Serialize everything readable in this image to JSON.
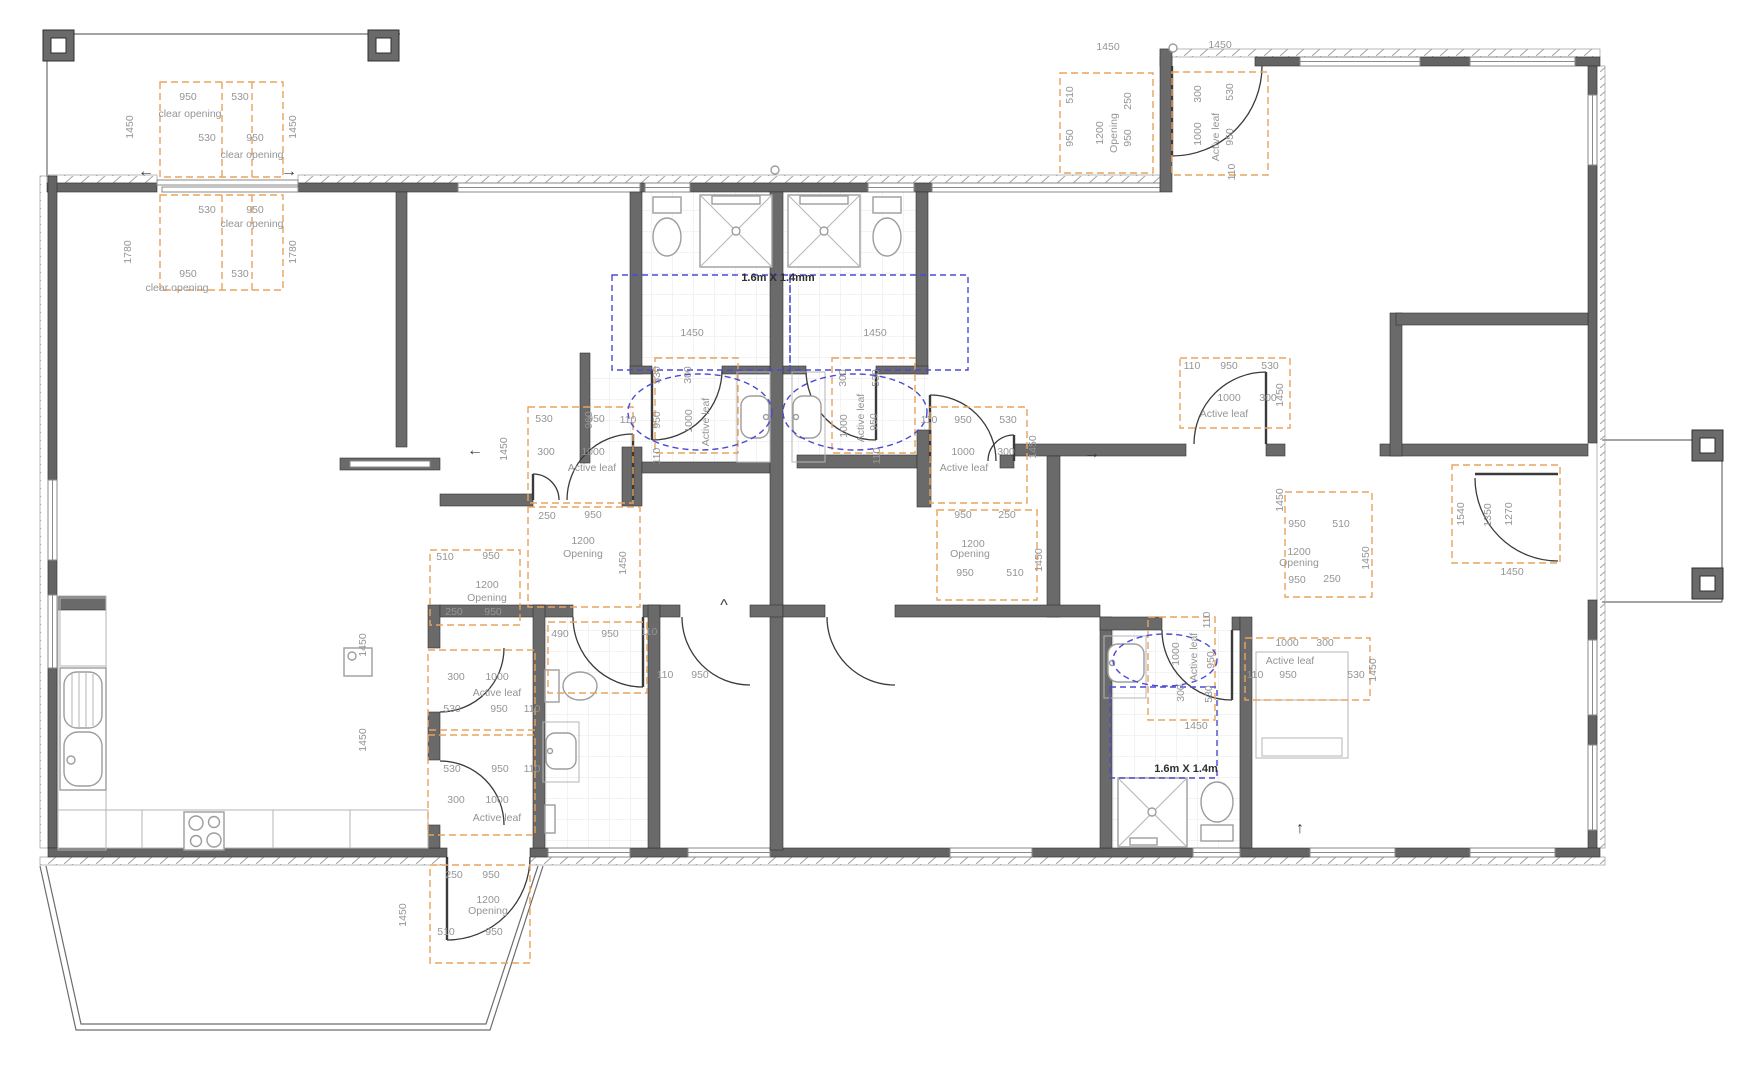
{
  "drawing": {
    "kind": "accessible-house-floor-plan",
    "turning_space_labels": [
      "1.6m X 1.4mm",
      "1.6m X 1.4m"
    ]
  },
  "colors": {
    "wall": "#646464",
    "clearance_dashed": "#e8a35f",
    "turning_dashed": "#4a4ad2",
    "dimension_text": "#959595",
    "background": "#ffffff"
  },
  "annotations": [
    {
      "t": "950",
      "x": 188,
      "y": 100
    },
    {
      "t": "530",
      "x": 240,
      "y": 100
    },
    {
      "t": "clear opening",
      "x": 190,
      "y": 117
    },
    {
      "t": "530",
      "x": 207,
      "y": 141
    },
    {
      "t": "950",
      "x": 255,
      "y": 141
    },
    {
      "t": "clear opening",
      "x": 252,
      "y": 158
    },
    {
      "t": "1450",
      "x": 133,
      "y": 127,
      "r": -90
    },
    {
      "t": "1450",
      "x": 296,
      "y": 127,
      "r": -90
    },
    {
      "t": "530",
      "x": 207,
      "y": 213
    },
    {
      "t": "950",
      "x": 255,
      "y": 213
    },
    {
      "t": "clear opening",
      "x": 252,
      "y": 227
    },
    {
      "t": "950",
      "x": 188,
      "y": 277
    },
    {
      "t": "530",
      "x": 240,
      "y": 277
    },
    {
      "t": "clear opening",
      "x": 177,
      "y": 291
    },
    {
      "t": "1780",
      "x": 131,
      "y": 252,
      "r": -90
    },
    {
      "t": "1780",
      "x": 296,
      "y": 252,
      "r": -90
    },
    {
      "t": "←",
      "x": 146,
      "y": 176,
      "k": "a"
    },
    {
      "t": "→",
      "x": 289,
      "y": 176,
      "k": "a"
    },
    {
      "t": "1450",
      "x": 1108,
      "y": 50
    },
    {
      "t": "1450",
      "x": 1220,
      "y": 48
    },
    {
      "t": "510",
      "x": 1073,
      "y": 95,
      "r": -90
    },
    {
      "t": "250",
      "x": 1131,
      "y": 101,
      "r": -90
    },
    {
      "t": "950",
      "x": 1073,
      "y": 138,
      "r": -90
    },
    {
      "t": "1200",
      "x": 1103,
      "y": 133,
      "r": -90
    },
    {
      "t": "Opening",
      "x": 1117,
      "y": 133,
      "r": -90
    },
    {
      "t": "950",
      "x": 1131,
      "y": 138,
      "r": -90
    },
    {
      "t": "300",
      "x": 1201,
      "y": 94,
      "r": -90
    },
    {
      "t": "530",
      "x": 1233,
      "y": 92,
      "r": -90
    },
    {
      "t": "1000",
      "x": 1201,
      "y": 134,
      "r": -90
    },
    {
      "t": "Active leaf",
      "x": 1219,
      "y": 137,
      "r": -90
    },
    {
      "t": "950",
      "x": 1233,
      "y": 137,
      "r": -90
    },
    {
      "t": "110",
      "x": 1235,
      "y": 172,
      "r": -90
    },
    {
      "t": "1.6m X 1.4mm",
      "x": 778,
      "y": 281,
      "k": "l"
    },
    {
      "t": "1450",
      "x": 692,
      "y": 336
    },
    {
      "t": "1450",
      "x": 875,
      "y": 336
    },
    {
      "t": "530",
      "x": 660,
      "y": 375,
      "r": -90
    },
    {
      "t": "300",
      "x": 691,
      "y": 375,
      "r": -90
    },
    {
      "t": "950",
      "x": 660,
      "y": 420,
      "r": -90
    },
    {
      "t": "1000",
      "x": 692,
      "y": 421,
      "r": -90
    },
    {
      "t": "Active leaf",
      "x": 709,
      "y": 422,
      "r": -90
    },
    {
      "t": "110",
      "x": 660,
      "y": 456,
      "r": -90
    },
    {
      "t": "960",
      "x": 592,
      "y": 420,
      "r": -90
    },
    {
      "t": "300",
      "x": 846,
      "y": 378,
      "r": -90
    },
    {
      "t": "530",
      "x": 879,
      "y": 378,
      "r": -90
    },
    {
      "t": "1000",
      "x": 847,
      "y": 426,
      "r": -90
    },
    {
      "t": "Active leaf",
      "x": 864,
      "y": 418,
      "r": -90
    },
    {
      "t": "950",
      "x": 877,
      "y": 422,
      "r": -90
    },
    {
      "t": "110",
      "x": 880,
      "y": 456,
      "r": -90
    },
    {
      "t": "530",
      "x": 544,
      "y": 422
    },
    {
      "t": "950",
      "x": 596,
      "y": 422
    },
    {
      "t": "110",
      "x": 628,
      "y": 423
    },
    {
      "t": "300",
      "x": 546,
      "y": 455
    },
    {
      "t": "1000",
      "x": 593,
      "y": 455
    },
    {
      "t": "Active leaf",
      "x": 592,
      "y": 471
    },
    {
      "t": "1450",
      "x": 507,
      "y": 449,
      "r": -90
    },
    {
      "t": "250",
      "x": 547,
      "y": 519
    },
    {
      "t": "950",
      "x": 593,
      "y": 518
    },
    {
      "t": "1200",
      "x": 583,
      "y": 544
    },
    {
      "t": "Opening",
      "x": 583,
      "y": 557
    },
    {
      "t": "1450",
      "x": 626,
      "y": 563,
      "r": -90
    },
    {
      "t": "510",
      "x": 445,
      "y": 560
    },
    {
      "t": "950",
      "x": 491,
      "y": 559
    },
    {
      "t": "1200",
      "x": 487,
      "y": 588
    },
    {
      "t": "Opening",
      "x": 487,
      "y": 601
    },
    {
      "t": "250",
      "x": 454,
      "y": 615
    },
    {
      "t": "950",
      "x": 493,
      "y": 615
    },
    {
      "t": "300",
      "x": 456,
      "y": 680
    },
    {
      "t": "1000",
      "x": 497,
      "y": 680
    },
    {
      "t": "Active leaf",
      "x": 497,
      "y": 696
    },
    {
      "t": "530",
      "x": 452,
      "y": 712
    },
    {
      "t": "950",
      "x": 499,
      "y": 712
    },
    {
      "t": "110",
      "x": 532,
      "y": 712
    },
    {
      "t": "530",
      "x": 452,
      "y": 772
    },
    {
      "t": "950",
      "x": 500,
      "y": 772
    },
    {
      "t": "110",
      "x": 532,
      "y": 772
    },
    {
      "t": "300",
      "x": 456,
      "y": 803
    },
    {
      "t": "1000",
      "x": 497,
      "y": 803
    },
    {
      "t": "Active leaf",
      "x": 497,
      "y": 821
    },
    {
      "t": "1450",
      "x": 366,
      "y": 645,
      "r": -90
    },
    {
      "t": "1450",
      "x": 366,
      "y": 740,
      "r": -90
    },
    {
      "t": "490",
      "x": 560,
      "y": 637
    },
    {
      "t": "950",
      "x": 610,
      "y": 637
    },
    {
      "t": "110",
      "x": 649,
      "y": 635
    },
    {
      "t": "110",
      "x": 665,
      "y": 678
    },
    {
      "t": "950",
      "x": 700,
      "y": 678
    },
    {
      "t": "250",
      "x": 454,
      "y": 878
    },
    {
      "t": "950",
      "x": 491,
      "y": 878
    },
    {
      "t": "1200",
      "x": 488,
      "y": 903
    },
    {
      "t": "Opening",
      "x": 488,
      "y": 914
    },
    {
      "t": "510",
      "x": 446,
      "y": 935
    },
    {
      "t": "950",
      "x": 494,
      "y": 935
    },
    {
      "t": "1450",
      "x": 406,
      "y": 915,
      "r": -90
    },
    {
      "t": "110",
      "x": 929,
      "y": 423
    },
    {
      "t": "950",
      "x": 963,
      "y": 423
    },
    {
      "t": "530",
      "x": 1008,
      "y": 423
    },
    {
      "t": "1000",
      "x": 963,
      "y": 455
    },
    {
      "t": "300",
      "x": 1006,
      "y": 455
    },
    {
      "t": "Active leaf",
      "x": 964,
      "y": 471
    },
    {
      "t": "1450",
      "x": 1036,
      "y": 447,
      "r": -90
    },
    {
      "t": "950",
      "x": 963,
      "y": 518
    },
    {
      "t": "250",
      "x": 1007,
      "y": 518
    },
    {
      "t": "1200",
      "x": 973,
      "y": 547
    },
    {
      "t": "Opening",
      "x": 970,
      "y": 557
    },
    {
      "t": "950",
      "x": 965,
      "y": 576
    },
    {
      "t": "510",
      "x": 1015,
      "y": 576
    },
    {
      "t": "1450",
      "x": 1042,
      "y": 560,
      "r": -90
    },
    {
      "t": "←",
      "x": 475,
      "y": 455,
      "k": "a"
    },
    {
      "t": "→",
      "x": 1092,
      "y": 458,
      "k": "a"
    },
    {
      "t": "^",
      "x": 724,
      "y": 610,
      "k": "a"
    },
    {
      "t": "↑",
      "x": 1300,
      "y": 833,
      "k": "a"
    },
    {
      "t": "110",
      "x": 1192,
      "y": 369
    },
    {
      "t": "950",
      "x": 1229,
      "y": 369
    },
    {
      "t": "530",
      "x": 1270,
      "y": 369
    },
    {
      "t": "1000",
      "x": 1229,
      "y": 401
    },
    {
      "t": "300",
      "x": 1268,
      "y": 401
    },
    {
      "t": "Active leaf",
      "x": 1224,
      "y": 417
    },
    {
      "t": "1450",
      "x": 1283,
      "y": 395,
      "r": -90
    },
    {
      "t": "950",
      "x": 1297,
      "y": 527
    },
    {
      "t": "510",
      "x": 1341,
      "y": 527
    },
    {
      "t": "1200",
      "x": 1299,
      "y": 555
    },
    {
      "t": "Opening",
      "x": 1299,
      "y": 566
    },
    {
      "t": "950",
      "x": 1297,
      "y": 583
    },
    {
      "t": "250",
      "x": 1332,
      "y": 582
    },
    {
      "t": "1450",
      "x": 1369,
      "y": 558,
      "r": -90
    },
    {
      "t": "1450",
      "x": 1283,
      "y": 500,
      "r": -90
    },
    {
      "t": "1540",
      "x": 1464,
      "y": 514,
      "r": -90
    },
    {
      "t": "1350",
      "x": 1491,
      "y": 515,
      "r": -90
    },
    {
      "t": "1270",
      "x": 1512,
      "y": 514,
      "r": -90
    },
    {
      "t": "1450",
      "x": 1512,
      "y": 575
    },
    {
      "t": "1000",
      "x": 1287,
      "y": 646
    },
    {
      "t": "300",
      "x": 1325,
      "y": 646
    },
    {
      "t": "Active leaf",
      "x": 1290,
      "y": 664
    },
    {
      "t": "110",
      "x": 1255,
      "y": 678
    },
    {
      "t": "950",
      "x": 1288,
      "y": 678
    },
    {
      "t": "530",
      "x": 1356,
      "y": 678
    },
    {
      "t": "1450",
      "x": 1376,
      "y": 670,
      "r": -90
    },
    {
      "t": "110",
      "x": 1210,
      "y": 620,
      "r": -90
    },
    {
      "t": "1000",
      "x": 1179,
      "y": 654,
      "r": -90
    },
    {
      "t": "Active leaf",
      "x": 1197,
      "y": 657,
      "r": -90
    },
    {
      "t": "950",
      "x": 1214,
      "y": 660,
      "r": -90
    },
    {
      "t": "300",
      "x": 1184,
      "y": 693,
      "r": -90
    },
    {
      "t": "530",
      "x": 1212,
      "y": 694,
      "r": -90
    },
    {
      "t": "1450",
      "x": 1196,
      "y": 729
    },
    {
      "t": "1.6m X 1.4m",
      "x": 1186,
      "y": 772,
      "k": "l"
    }
  ]
}
